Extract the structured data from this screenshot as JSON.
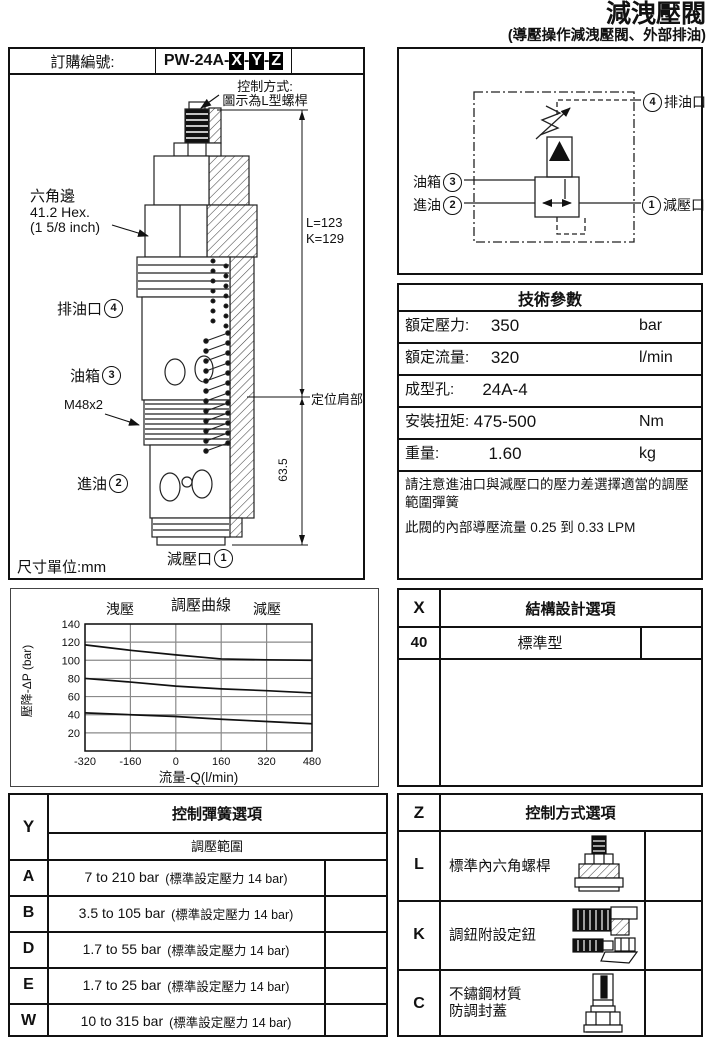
{
  "title_block": {
    "title": "減洩壓閥",
    "subtitle": "(導壓操作減洩壓閥、外部排油)"
  },
  "ordering": {
    "label": "訂購編號:",
    "prefix": "PW-24A-",
    "x": "X",
    "y": "Y",
    "z": "Z",
    "sep": "-"
  },
  "drawing": {
    "control_note1": "控制方式:",
    "control_note2": "圖示為L型螺桿",
    "hex1": "六角邊",
    "hex2": "41.2 Hex.",
    "hex3": "(1 5/8 inch)",
    "port4": "排油口",
    "port4_num": "4",
    "port3": "油箱",
    "port3_num": "3",
    "thread": "M48x2",
    "port2": "進油",
    "port2_num": "2",
    "port1": "減壓口",
    "port1_num": "1",
    "dim_l": "L=123",
    "dim_k": "K=129",
    "shoulder": "定位肩部",
    "dim_height": "63.5",
    "units": "尺寸單位:mm"
  },
  "schematic": {
    "port4": "排油口",
    "port4_num": "4",
    "port3": "油箱",
    "port3_num": "3",
    "port2": "進油",
    "port2_num": "2",
    "port1": "減壓口",
    "port1_num": "1"
  },
  "tech": {
    "title": "技術參數",
    "rows": [
      {
        "label": "額定壓力:",
        "value": "350",
        "unit": "bar"
      },
      {
        "label": "額定流量:",
        "value": "320",
        "unit": "l/min"
      },
      {
        "label": "成型孔:",
        "value": "24A-4",
        "unit": ""
      },
      {
        "label": "安裝扭矩:",
        "value": "475-500",
        "unit": "Nm"
      },
      {
        "label": "重量:",
        "value": "1.60",
        "unit": "kg"
      }
    ],
    "note1": "請注意進油口與減壓口的壓力差選擇適當的調壓範圍彈簧",
    "note2": "此閥的內部導壓流量 0.25 到 0.33 LPM"
  },
  "x_table": {
    "key": "X",
    "title": "結構設計選項",
    "row_code": "40",
    "row_label": "標準型"
  },
  "y_table": {
    "key": "Y",
    "title": "控制彈簧選項",
    "subtitle": "調壓範圍",
    "rows": [
      {
        "code": "A",
        "range": "7 to 210 bar",
        "note": "(標準設定壓力 14 bar)"
      },
      {
        "code": "B",
        "range": "3.5 to 105 bar",
        "note": "(標準設定壓力 14 bar)"
      },
      {
        "code": "D",
        "range": "1.7 to 55 bar",
        "note": "(標準設定壓力 14 bar)"
      },
      {
        "code": "E",
        "range": "1.7 to 25 bar",
        "note": "(標準設定壓力 14 bar)"
      },
      {
        "code": "W",
        "range": "10 to 315 bar",
        "note": "(標準設定壓力 14 bar)"
      }
    ]
  },
  "z_table": {
    "key": "Z",
    "title": "控制方式選項",
    "rows": [
      {
        "code": "L",
        "label1": "標準內六角螺桿",
        "label2": "",
        "icon": "socket-screw-icon"
      },
      {
        "code": "K",
        "label1": "調鈕附設定鈕",
        "label2": "",
        "icon": "adjust-knob-icon"
      },
      {
        "code": "C",
        "label1": "不鏽鋼材質",
        "label2": "防調封蓋",
        "icon": "tamper-proof-cap-icon"
      }
    ]
  },
  "chart_data": {
    "type": "line",
    "title": "調壓曲線",
    "label_left": "洩壓",
    "label_right": "減壓",
    "xlabel": "流量-Q(l/min)",
    "ylabel": "壓降-ΔP (bar)",
    "xlim": [
      -320,
      480
    ],
    "ylim": [
      0,
      140
    ],
    "xticks": [
      -320,
      -160,
      0,
      160,
      320,
      480
    ],
    "yticks": [
      20,
      40,
      60,
      80,
      100,
      120,
      140
    ],
    "grid": true,
    "legend_position": "none",
    "x": [
      -320,
      -160,
      0,
      160,
      320,
      480
    ],
    "series": [
      {
        "name": "curve-high",
        "values": [
          117,
          111,
          106,
          101.5,
          100.5,
          100
        ]
      },
      {
        "name": "curve-mid",
        "values": [
          80,
          76,
          71.5,
          68.5,
          66.5,
          64
        ]
      },
      {
        "name": "curve-low",
        "values": [
          42,
          40,
          38,
          35,
          32.5,
          30
        ]
      }
    ]
  }
}
